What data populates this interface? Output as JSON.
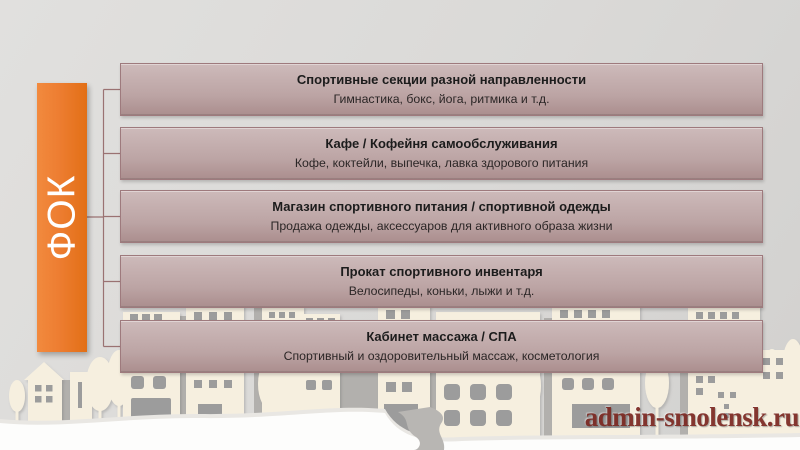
{
  "slide": {
    "org_label": "ФОК",
    "services": [
      {
        "title": "Спортивные секции разной направленности",
        "subtitle": "Гимнастика, бокс, йога, ритмика и т.д."
      },
      {
        "title": "Кафе / Кофейня самообслуживания",
        "subtitle": "Кофе, коктейли, выпечка, лавка здорового питания"
      },
      {
        "title": "Магазин спортивного питания / спортивной одежды",
        "subtitle": "Продажа одежды, аксессуаров для активного образа жизни"
      },
      {
        "title": "Прокат спортивного инвентаря",
        "subtitle": "Велосипеды, коньки, лыжи и т.д."
      },
      {
        "title": "Кабинет массажа / СПА",
        "subtitle": "Спортивный и оздоровительный массаж, косметология"
      }
    ],
    "watermark": "admin-smolensk.ru",
    "colors": {
      "accent_orange": "#ed7d31",
      "box_gradient_top": "#cdbaba",
      "box_gradient_bottom": "#ab8e8e",
      "box_border": "#9e7a7d",
      "connector_line": "#9a7272",
      "background": "#dad9d7",
      "watermark": "#7b2721",
      "title_text": "#1c1c1c",
      "subtitle_text": "#2b2626",
      "bar_text": "#ffffff",
      "skyline_cream": "#f6efdf",
      "skyline_gray": "#b2b0ad",
      "window_gray": "#9c9c9c"
    }
  }
}
